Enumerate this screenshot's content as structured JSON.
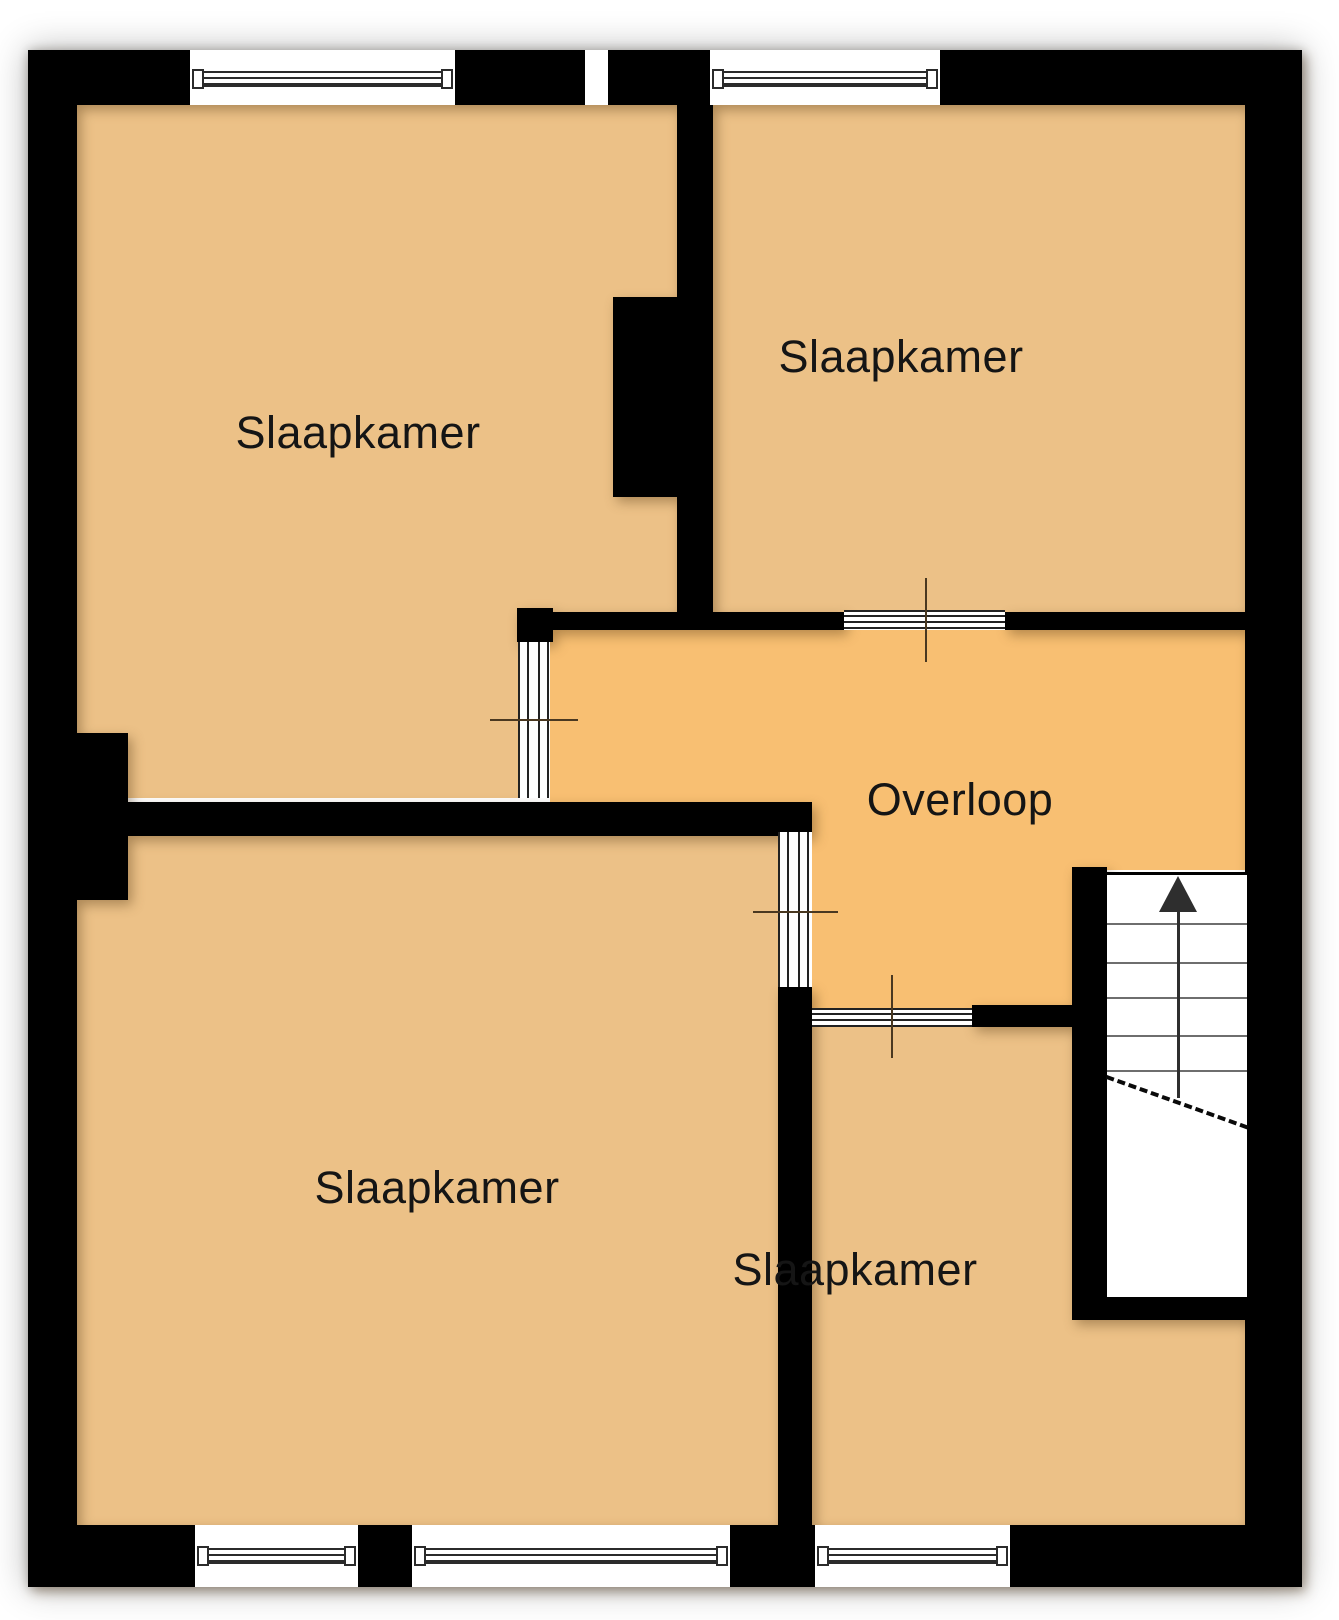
{
  "floorplan": {
    "rooms": [
      {
        "id": "bedroom-top-left",
        "label": "Slaapkamer"
      },
      {
        "id": "bedroom-top-right",
        "label": "Slaapkamer"
      },
      {
        "id": "landing",
        "label": "Overloop"
      },
      {
        "id": "bedroom-bottom-left",
        "label": "Slaapkamer"
      },
      {
        "id": "bedroom-bottom-right",
        "label": "Slaapkamer"
      }
    ],
    "stairs": {
      "direction": "up",
      "arrow_icon": "up-arrow",
      "tread_lines": 5
    },
    "openings": {
      "windows_top_wall": 2,
      "windows_bottom_wall": 3,
      "interior_doors": 4
    },
    "colors": {
      "wall": "#000000",
      "bedroom_floor": "#ecc187",
      "landing_floor": "#f8bf72",
      "stairwell": "#ffffff",
      "page_background": "#ffffff",
      "label_text": "#151515"
    }
  }
}
